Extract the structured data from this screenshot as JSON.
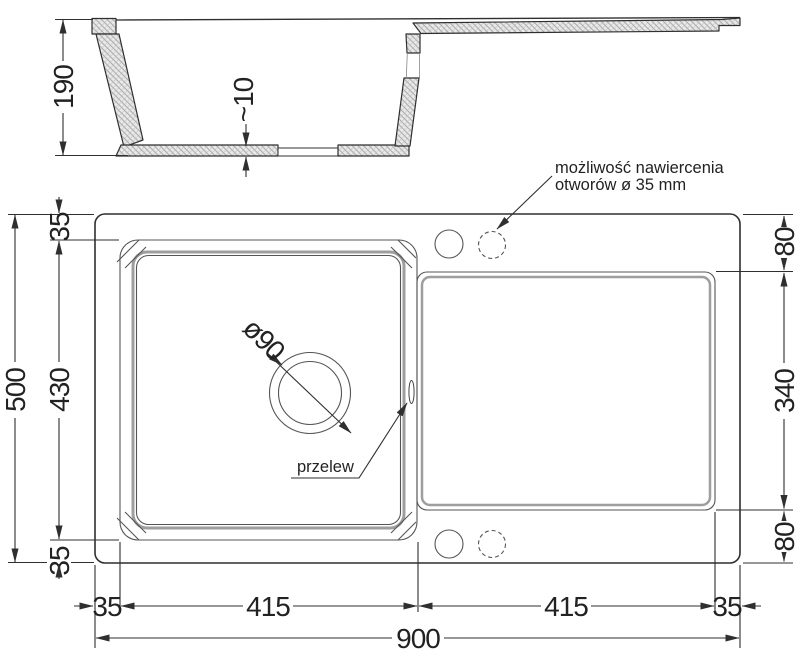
{
  "section": {
    "depth": "190",
    "floor_thickness": "~10"
  },
  "plan": {
    "total_width": "900",
    "total_height": "500",
    "left_margin": "35",
    "top_margin": "35",
    "bowl_width": "415",
    "bowl_height": "430",
    "bottom_margin": "35",
    "drainer_width": "415",
    "right_margin": "35",
    "drainer_offset_top": "80",
    "drainer_length": "340",
    "drainer_offset_bottom": "80",
    "drain_label": "ø90",
    "overflow_label": "przelew",
    "note_line1": "możliwość nawiercenia",
    "note_line2": "otworów ø 35 mm"
  },
  "colors": {
    "line": "#2f2f2f",
    "rim_gray": "#9e9e9e"
  }
}
